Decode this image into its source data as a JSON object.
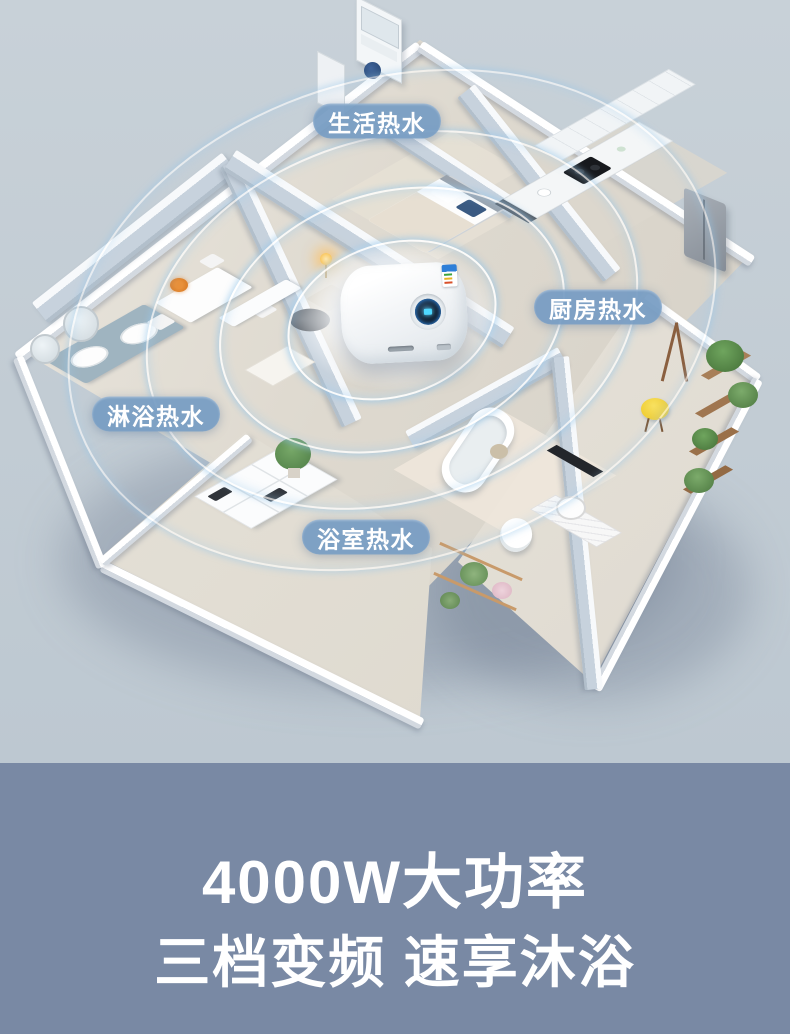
{
  "scene": {
    "callouts": [
      {
        "id": "domestic-hot-water",
        "text": "生活热水"
      },
      {
        "id": "kitchen-hot-water",
        "text": "厨房热水"
      },
      {
        "id": "shower-hot-water",
        "text": "淋浴热水"
      },
      {
        "id": "bathroom-hot-water",
        "text": "浴室热水"
      }
    ],
    "heater": {
      "kind": "wall-mounted electric storage water heater"
    }
  },
  "footer": {
    "line1": "4000W大功率",
    "line2": "三档变频 速享沐浴"
  },
  "colors": {
    "canvas_top": "#c4ced6",
    "footer_band": "#7989a4",
    "callout_pill": "#769cc3",
    "ripple_glow": "#a9d3ee",
    "heater_display_ring": "#2f7fd1",
    "stool_yellow": "#f4d636"
  }
}
